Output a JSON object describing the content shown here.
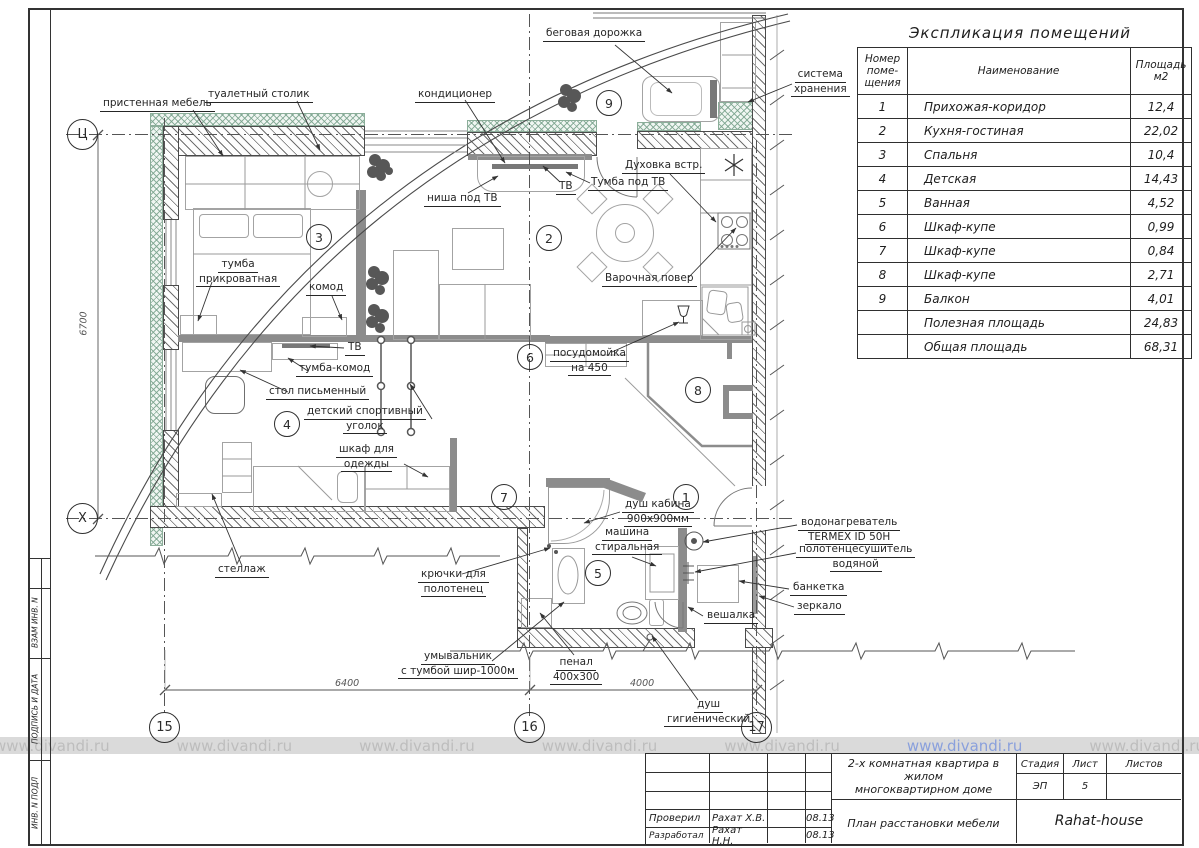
{
  "explication": {
    "title": "Экспликация  помещений",
    "headers": {
      "num": "Номер\nпоме-\nщения",
      "name": "Наименование",
      "area": "Площадь\nм2"
    },
    "rows": [
      {
        "num": "1",
        "name": "Прихожая-коридор",
        "area": "12,4"
      },
      {
        "num": "2",
        "name": "Кухня-гостиная",
        "area": "22,02"
      },
      {
        "num": "3",
        "name": "Спальня",
        "area": "10,4"
      },
      {
        "num": "4",
        "name": "Детская",
        "area": "14,43"
      },
      {
        "num": "5",
        "name": "Ванная",
        "area": "4,52"
      },
      {
        "num": "6",
        "name": "Шкаф-купе",
        "area": "0,99"
      },
      {
        "num": "7",
        "name": "Шкаф-купе",
        "area": "0,84"
      },
      {
        "num": "8",
        "name": "Шкаф-купе",
        "area": "2,71"
      },
      {
        "num": "9",
        "name": "Балкон",
        "area": "4,01"
      },
      {
        "num": "",
        "name": "Полезная площадь",
        "area": "24,83"
      },
      {
        "num": "",
        "name": "Общая площадь",
        "area": "68,31"
      }
    ]
  },
  "titleblock": {
    "checked_label": "Проверил",
    "checked_name": "Рахат Х.В.",
    "checked_date": "08.13",
    "developed_label": "Разработал",
    "developed_name": "Рахат Н.Н.",
    "developed_date": "08.13",
    "project": "2-х комнатная квартира в жилом\nмногоквартирном доме",
    "doc_title": "План расстановки мебели",
    "stage_label": "Стадия",
    "sheet_label": "Лист",
    "sheets_label": "Листов",
    "stage": "ЭП",
    "sheet": "5",
    "sheets": "",
    "brand": "Rahat-house"
  },
  "sidebar": {
    "cell1": "ВЗАМ  ИНВ. N",
    "cell2": "ПОДПИСЬ И ДАТА",
    "cell3": "ИНВ. N ПОДЛ"
  },
  "watermark": {
    "text": "www.divandi.ru"
  },
  "plan": {
    "axes": {
      "c": "Ц",
      "x": "Х",
      "n15": "15",
      "n16": "16",
      "n17": "17"
    },
    "dims": {
      "v": "6700",
      "h1": "6400",
      "h2": "4000"
    },
    "rooms": {
      "r1": "1",
      "r2": "2",
      "r3": "3",
      "r4": "4",
      "r5": "5",
      "r6": "6",
      "r7": "7",
      "r8": "8",
      "r9": "9"
    },
    "labels": {
      "begovaya": "беговая дорожка",
      "sistema": [
        "система",
        "хранения"
      ],
      "pristennaya": "пристенная мебель",
      "tualetny": "туалетный столик",
      "kondicioner": "кондиционер",
      "nisha_tv": "ниша под ТВ",
      "tv_top": "ТВ",
      "tumba_pod_tv": "Тумба под ТВ",
      "duhovka": "Духовка встр.",
      "varochnaya": "Варочная повер",
      "tumba_prikrovatnaya": [
        "тумба",
        "прикроватная"
      ],
      "komod": "комод",
      "tv_mid": "ТВ",
      "tumba_komod": "тумба-комод",
      "stol_pismenny": "стол письменный",
      "sport_ugolok": [
        "детский спортивный",
        "уголок"
      ],
      "shkaf_dlya_odezhdy": [
        "шкаф для",
        "одежды"
      ],
      "posudomoika": [
        "посудомойка",
        "на 450"
      ],
      "stellazh": "стеллаж",
      "kryuchki": [
        "крючки для",
        "полотенец"
      ],
      "umyvalnik": [
        "умывальник",
        "с тумбой шир-1000м"
      ],
      "penal": [
        "пенал",
        "400х300"
      ],
      "dush_kabina": [
        "душ кабина",
        "900х900мм"
      ],
      "mashina": [
        "машина",
        "стиральная"
      ],
      "dush_gig": [
        "душ",
        "гигиенический"
      ],
      "vodonagrevatel": [
        "водонагреватель",
        "TERMEX ID 50H"
      ],
      "polotencesushitel": [
        "полотенцесушитель",
        "водяной"
      ],
      "banketka": "банкетка",
      "zerkalo": "зеркало",
      "veshalka": "вешалка"
    }
  }
}
